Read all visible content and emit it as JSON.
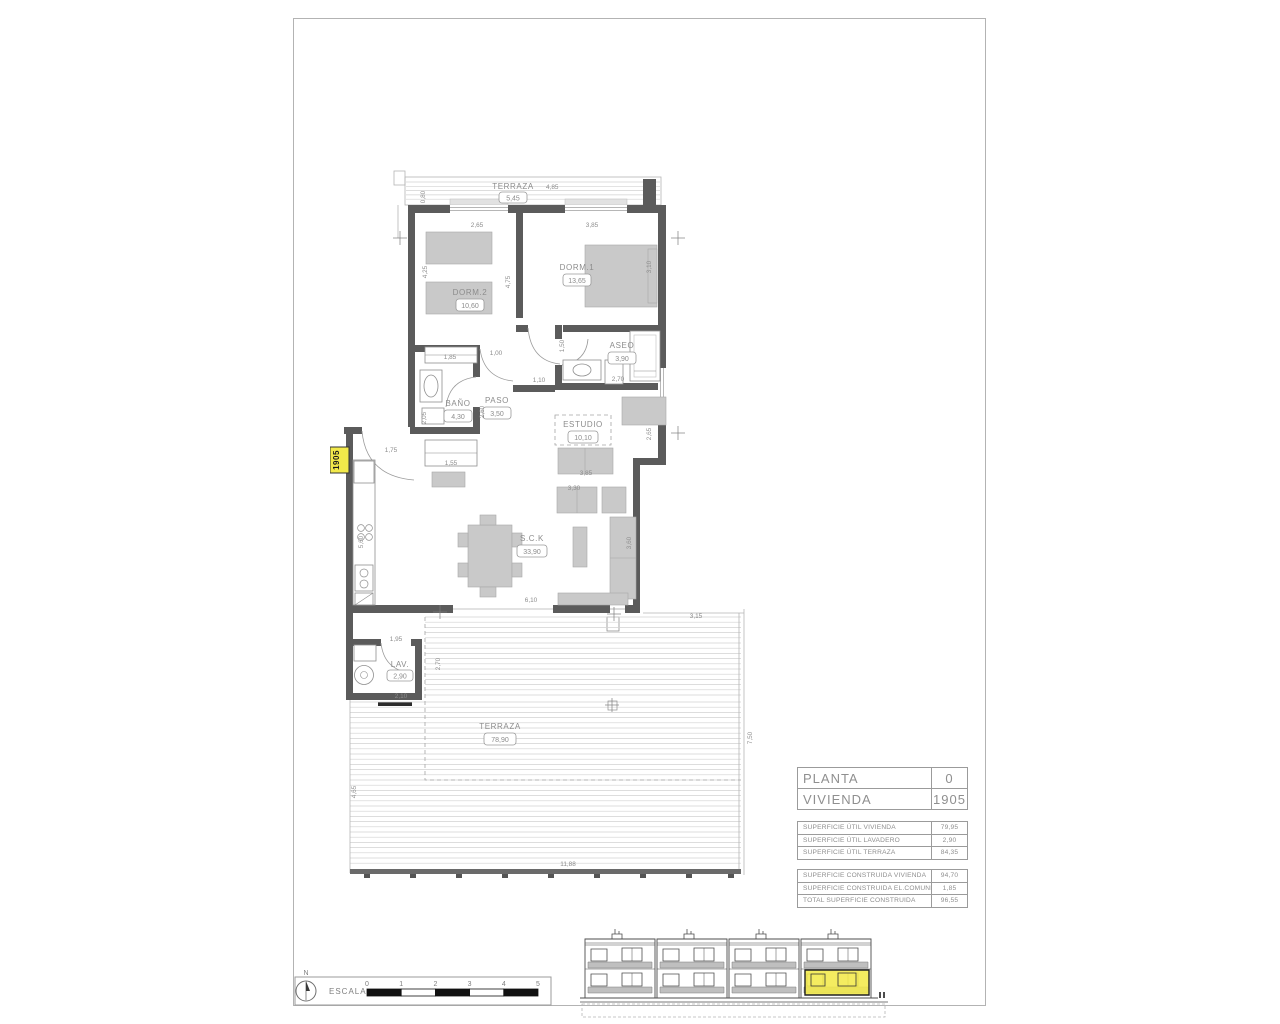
{
  "plan": {
    "unit_tag": "1905",
    "rooms": {
      "terraza_top": {
        "name": "TERRAZA",
        "dim": "4,85",
        "area": "5,45"
      },
      "dorm2": {
        "name": "DORM.2",
        "area": "10,60"
      },
      "dorm1": {
        "name": "DORM.1",
        "area": "13,65"
      },
      "aseo": {
        "name": "ASEO",
        "area": "3,90"
      },
      "bano": {
        "name": "BAÑO",
        "area": "4,30"
      },
      "paso": {
        "name": "PASO",
        "area": "3,50"
      },
      "estudio": {
        "name": "ESTUDIO",
        "area": "10,10"
      },
      "sck": {
        "name": "S.C.K",
        "area": "33,90"
      },
      "lav": {
        "name": "LAV.",
        "area": "2,90"
      },
      "terraza_main": {
        "name": "TERRAZA",
        "area": "78,90"
      }
    },
    "dims": [
      "0,80",
      "2,65",
      "3,85",
      "4,25",
      "4,75",
      "3,10",
      "1,85",
      "1,00",
      "1,50",
      "2,70",
      "1,10",
      "2,05",
      "2,60",
      "1,55",
      "2,65",
      "3,85",
      "3,30",
      "3,60",
      "6,10",
      "5,60",
      "1,75",
      "1,95",
      "2,70",
      "2,10",
      "3,15",
      "7,50",
      "11,88",
      "4,65"
    ]
  },
  "title_block": {
    "planta_label": "PLANTA",
    "planta_value": "0",
    "vivienda_label": "VIVIENDA",
    "vivienda_value": "1905",
    "util_rows": [
      {
        "label": "SUPERFICIE ÚTIL VIVIENDA",
        "value": "79,95"
      },
      {
        "label": "SUPERFICIE ÚTIL LAVADERO",
        "value": "2,90"
      },
      {
        "label": "SUPERFICIE ÚTIL TERRAZA",
        "value": "84,35"
      }
    ],
    "built_rows": [
      {
        "label": "SUPERFICIE CONSTRUIDA VIVIENDA",
        "value": "94,70"
      },
      {
        "label": "SUPERFICIE CONSTRUIDA EL.COMUNES",
        "value": "1,85"
      },
      {
        "label": "TOTAL SUPERFICIE CONSTRUIDA",
        "value": "96,55"
      }
    ]
  },
  "scale_bar": {
    "north": "N",
    "label": "ESCALA :",
    "ticks": [
      "0",
      "1",
      "2",
      "3",
      "4",
      "5"
    ]
  },
  "colors": {
    "wall": "#5b5b5b",
    "furniture": "#c9c9c9",
    "highlight_yellow": "#f2e94a",
    "dim_text": "#8c8c8c"
  }
}
